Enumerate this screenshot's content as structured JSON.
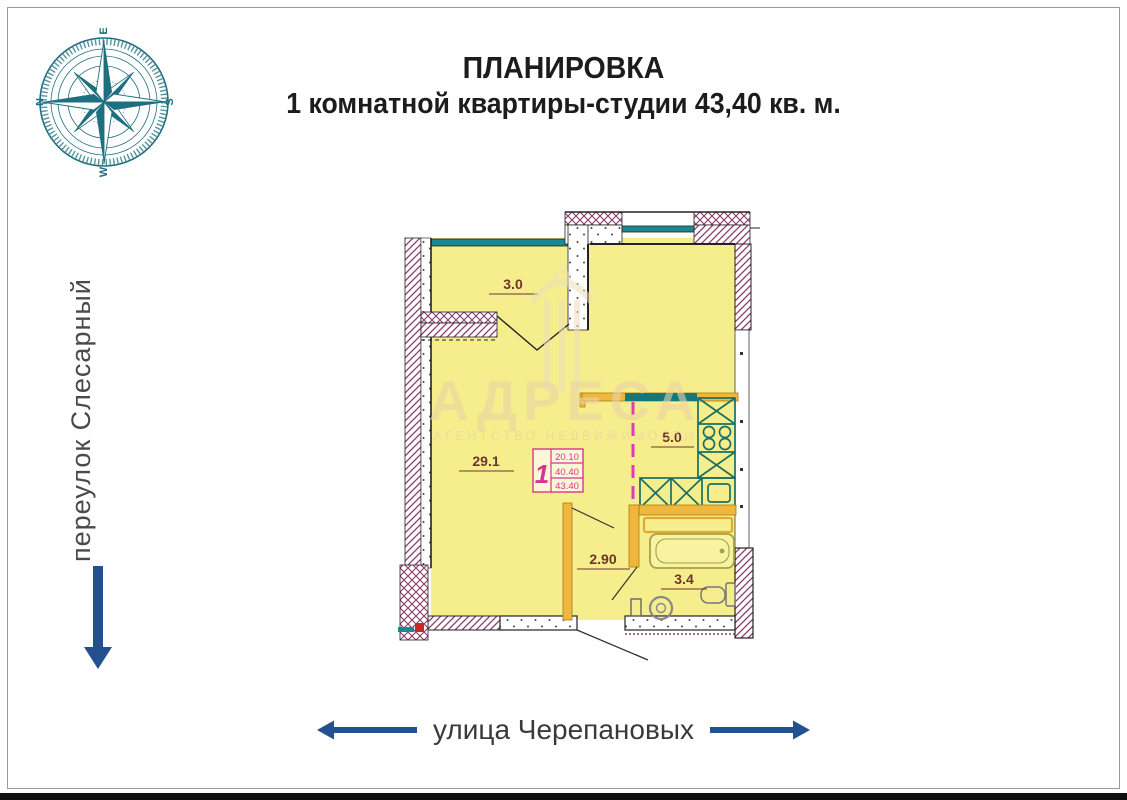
{
  "title": {
    "line1": "ПЛАНИРОВКА",
    "line2": "1 комнатной квартиры-студии 43,40 кв. м."
  },
  "compass": {
    "points": {
      "top": "E",
      "left": "N",
      "right": "S",
      "bottom": "W"
    },
    "color": "#1e6f7f"
  },
  "streets": {
    "left": {
      "name": "переулок Слесарный",
      "arrow": "down"
    },
    "bottom": {
      "name": "улица Черепановых",
      "arrows": "left-right"
    },
    "arrow_color": "#24508f"
  },
  "watermark": {
    "brand": "АДРЕСА",
    "subtitle": "АГЕНТСТВО НЕДВИЖИМОСТИ"
  },
  "floor_plan": {
    "total_area_label": "43,40",
    "rooms": [
      {
        "name": "balcony",
        "area_label": "3.0"
      },
      {
        "name": "living-room",
        "area_label": "29.1"
      },
      {
        "name": "kitchen",
        "area_label": "5.0"
      },
      {
        "name": "hallway",
        "area_label": "2.90"
      },
      {
        "name": "bathroom",
        "area_label": "3.4"
      }
    ],
    "stamp": {
      "unit": "1",
      "values": [
        "20.10",
        "40.40",
        "43.40"
      ]
    },
    "colors": {
      "room_fill": "#f6ee8d",
      "wall_hatch": "#8a3a6a",
      "window": "#1a8a8e",
      "partition": "#f0b73f",
      "kitchen_fixture": "#1a6f63",
      "dash_line": "#e03ab8",
      "stamp": "#d6358f",
      "label": "#6d342c",
      "arrow_blue": "#24508f"
    }
  }
}
